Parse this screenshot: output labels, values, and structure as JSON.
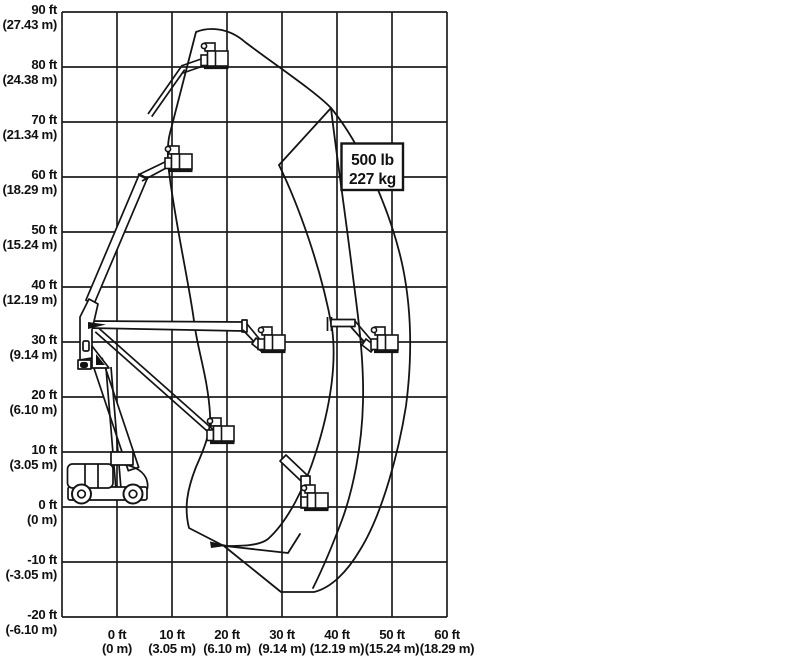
{
  "title": "Boom lift range of motion diagram",
  "capacity_label": {
    "line1": "500 lb",
    "line2": "227 kg"
  },
  "axes": {
    "y": [
      {
        "ft": "90 ft",
        "m": "(27.43 m)"
      },
      {
        "ft": "80 ft",
        "m": "(24.38 m)"
      },
      {
        "ft": "70 ft",
        "m": "(21.34 m)"
      },
      {
        "ft": "60 ft",
        "m": "(18.29 m)"
      },
      {
        "ft": "50 ft",
        "m": "(15.24 m)"
      },
      {
        "ft": "40 ft",
        "m": "(12.19 m)"
      },
      {
        "ft": "30 ft",
        "m": "(9.14 m)"
      },
      {
        "ft": "20 ft",
        "m": "(6.10 m)"
      },
      {
        "ft": "10 ft",
        "m": "(3.05 m)"
      },
      {
        "ft": "0 ft",
        "m": "(0 m)"
      },
      {
        "ft": "-10 ft",
        "m": "(-3.05 m)"
      },
      {
        "ft": "-20 ft",
        "m": "(-6.10 m)"
      }
    ],
    "x": [
      {
        "ft": "0 ft",
        "m": "(0 m)"
      },
      {
        "ft": "10 ft",
        "m": "(3.05 m)"
      },
      {
        "ft": "20 ft",
        "m": "(6.10 m)"
      },
      {
        "ft": "30 ft",
        "m": "(9.14 m)"
      },
      {
        "ft": "40 ft",
        "m": "(12.19 m)"
      },
      {
        "ft": "50 ft",
        "m": "(15.24 m)"
      },
      {
        "ft": "60 ft",
        "m": "(18.29 m)"
      }
    ]
  },
  "chart_data": {
    "type": "range-diagram",
    "title": "Articulating boom lift working envelope",
    "capacity": {
      "pounds": 500,
      "kilograms": 227
    },
    "x_axis": {
      "label_unit": "ft / m",
      "tick_values_ft": [
        0,
        10,
        20,
        30,
        40,
        50,
        60
      ],
      "grid_range_ft": [
        -10,
        60
      ],
      "grid_step_ft": 10
    },
    "y_axis": {
      "label_unit": "ft / m",
      "tick_values_ft": [
        90,
        80,
        70,
        60,
        50,
        40,
        30,
        20,
        10,
        0,
        -10,
        -20
      ],
      "grid_range_ft": [
        -20,
        90
      ],
      "grid_step_ft": 10
    },
    "grid": "on",
    "envelope_outline_ft": [
      [
        14.5,
        86.5
      ],
      [
        24,
        85
      ],
      [
        39,
        72.5
      ],
      [
        52,
        43.5
      ],
      [
        54,
        28
      ],
      [
        52.5,
        18.5
      ],
      [
        44,
        -8
      ],
      [
        36,
        -15.5
      ],
      [
        30,
        -15.5
      ],
      [
        19.5,
        -7
      ],
      [
        13,
        -4
      ],
      [
        14.5,
        7.5
      ],
      [
        17,
        17
      ],
      [
        14,
        34
      ],
      [
        10,
        57
      ],
      [
        9.5,
        68
      ]
    ],
    "inner_boundary_a_ft": [
      [
        39,
        72.5
      ],
      [
        42.5,
        42
      ],
      [
        45,
        19
      ],
      [
        42.5,
        3
      ],
      [
        35.5,
        -15
      ]
    ],
    "inner_boundary_b_ft": [
      [
        39,
        72.5
      ],
      [
        29.5,
        62
      ],
      [
        39,
        32.5
      ],
      [
        36,
        -10
      ],
      [
        19.5,
        -7
      ]
    ],
    "platform_positions_ft": [
      [
        18,
        82
      ],
      [
        12,
        63
      ],
      [
        28.5,
        30
      ],
      [
        49,
        30
      ],
      [
        19.5,
        13.5
      ],
      [
        36.5,
        1
      ]
    ]
  }
}
